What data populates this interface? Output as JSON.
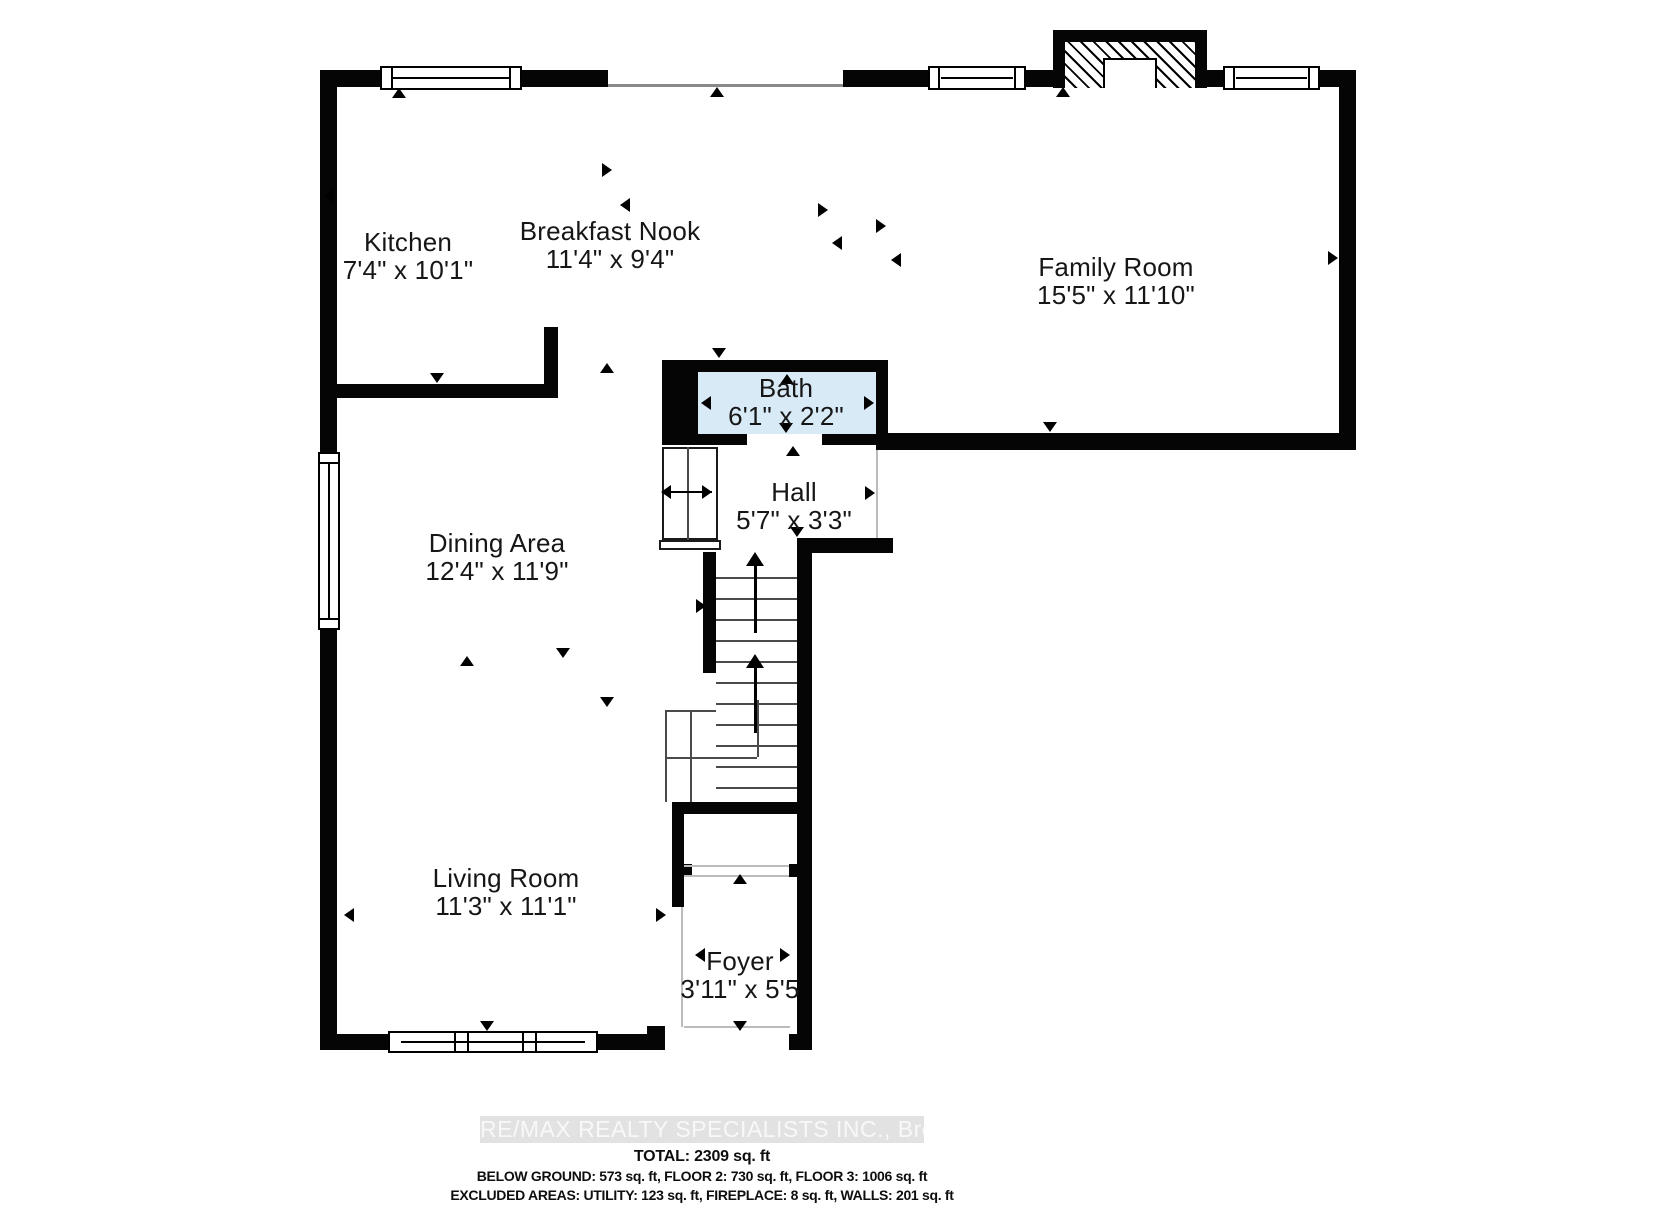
{
  "rooms": [
    {
      "name": "Kitchen",
      "dims": "7'4\" x 10'1\""
    },
    {
      "name": "Breakfast Nook",
      "dims": "11'4\" x 9'4\""
    },
    {
      "name": "Family Room",
      "dims": "15'5\" x 11'10\""
    },
    {
      "name": "Bath",
      "dims": "6'1\" x 2'2\""
    },
    {
      "name": "Hall",
      "dims": "5'7\" x 3'3\""
    },
    {
      "name": "Dining Area",
      "dims": "12'4\" x 11'9\""
    },
    {
      "name": "Living Room",
      "dims": "11'3\" x 11'1\""
    },
    {
      "name": "Foyer",
      "dims": "3'11\" x 5'5"
    }
  ],
  "watermark": "RE/MAX REALTY SPECIALISTS INC., Brokerage",
  "summary": {
    "total": "TOTAL: 2309 sq. ft",
    "floors": "BELOW GROUND: 573 sq. ft, FLOOR 2: 730 sq. ft, FLOOR 3: 1006 sq. ft",
    "excluded": "EXCLUDED AREAS: UTILITY: 123 sq. ft, FIREPLACE: 8 sq. ft, WALLS: 201 sq. ft"
  },
  "colors": {
    "wall": "#050505",
    "bath_fill": "#d9eaf7",
    "watermark_bg": "#e2e2e2",
    "watermark_text": "#f8f8f8"
  }
}
